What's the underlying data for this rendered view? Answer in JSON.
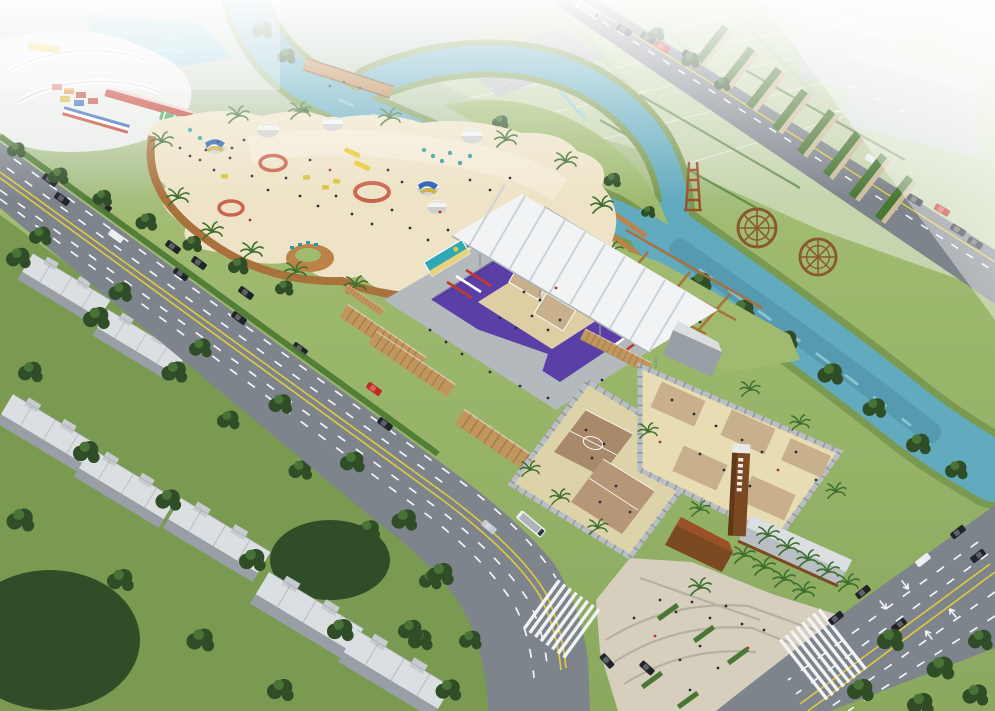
{
  "meta": {
    "title": "Aerial rendering of beach volleyball venue",
    "width": 995,
    "height": 711
  },
  "scene": {
    "description": "Bird's-eye architectural rendering: beach volleyball stadium with purple stands and white canopy, sand beach park with volleyball-pattern dome tents, fenced outdoor sand courts, a teal canal with wooden bridge and waterwheel sculptures, farmland in the haze, multi-lane roads with traffic, and gray residential slabs among trees.",
    "elements": [
      {
        "name": "stadium",
        "details": "U-shaped grandstand, purple seats, white ribbed canopy, central sand court with two tan match courts"
      },
      {
        "name": "beach-park",
        "details": "large free-form sand beach, dome tents (white and volleyball blue/yellow), red sand-art rings, yellow slides and buggies, teal loungers, palms, crowds"
      },
      {
        "name": "outdoor-courts",
        "details": "two walled enclosures: one with two brown courts, one with sand and five tan practice courts"
      },
      {
        "name": "sign-tower",
        "details": "tall wooden pylon with vertical sign marks (text not legible)"
      },
      {
        "name": "river",
        "details": "teal canal forking around a green island; wooden bridge, bank piers, two lattice waterwheel sculptures, wooden tower sculpture"
      },
      {
        "name": "main-road",
        "details": "diagonal arterial with double yellow centerline, dashed lanes, cars, white bus, zebra crossing"
      },
      {
        "name": "cross-road",
        "details": "second road lower right with lane arrows, zebra crossing, cars"
      },
      {
        "name": "top-road",
        "details": "road along the farmland with bus and cars"
      },
      {
        "name": "farmland",
        "details": "pale green crop plots with hedge rows fading into mist"
      },
      {
        "name": "northwest-venue",
        "details": "white curved leisure complex with pond, red-roof building, green striped pavilions, colorful stands"
      },
      {
        "name": "residential",
        "details": "seven gray apartment slabs among dense dark trees"
      },
      {
        "name": "plaza",
        "details": "paved entry plaza with planters, palm rows and pedestrians"
      },
      {
        "name": "hazy-buildings",
        "details": "fog-covered gray boxes upper right with flying birds"
      }
    ],
    "approx_counts": {
      "dome_tents": 6,
      "waterwheels": 2,
      "enclosed_courts": 7,
      "apartment_blocks": 7,
      "vehicles": 34,
      "sand_art_rings": 3
    }
  },
  "colors": {
    "mist": "#ffffff",
    "sky_top": "#c6d1d3",
    "grass": "#8aa95e",
    "grass_light": "#a0bb70",
    "grass_dark": "#7a9a52",
    "farmland": "#c6d5ae",
    "farmland_alt": "#b7cb9d",
    "tree_dark": "#2f4d27",
    "tree_mid": "#497336",
    "tree_light": "#68944a",
    "palm": "#3f7030",
    "hedge": "#4a7833",
    "river": "#62abbe",
    "river_light": "#93ccd6",
    "river_deep": "#47899e",
    "lake": "#7fc0cf",
    "road": "#7e848c",
    "road_dark": "#6d737b",
    "lane_white": "#f2f4f5",
    "lane_yellow": "#e2c93e",
    "sidewalk": "#b8bcc0",
    "plaza_paving": "#d6cfbd",
    "plaza_band": "#b3ada0",
    "plaza_gray": "#b4b9bd",
    "sand_beach": "#eee3c6",
    "sand_bright": "#f5edd9",
    "sand_stadium": "#dfcda4",
    "sand_outdoor": "#e8ddb2",
    "court_tan": "#c8b08d",
    "court_brown": "#a8896a",
    "court_brown2": "#b59778",
    "boardwalk": "#a9713c",
    "wood_deck": "#bc8348",
    "wood_dark": "#7c4a22",
    "container": "#c0965c",
    "container_dark": "#9f7a42",
    "seat_purple": "#5a3fa6",
    "seat_purple_dark": "#46318a",
    "canopy": "#f1f3f4",
    "canopy_rib": "#ccd3d6",
    "wall_gray": "#b9bec2",
    "wall_dark": "#8f959a",
    "building_face": "#c7cbcf",
    "building_side": "#989fa6",
    "building_top": "#dcdfe2",
    "haze_building": "#ccd3d6",
    "wood_structure": "#8b5930",
    "rust": "#9c5027",
    "red_accent": "#c03a2b",
    "sand_art": "#c0452e",
    "billboard_teal": "#2fa9b8",
    "billboard_sand": "#e6d37a",
    "kiosk_green": "#47a156",
    "bus_white": "#eef0f1",
    "car_black": "#20242a",
    "car_red": "#c22a1f",
    "car_silver": "#c7cbd0",
    "car_white": "#e9ebec",
    "people": "#2c3038",
    "people_accent": "#b5352c",
    "slide_yellow": "#e8c832",
    "umbrella_teal": "#2e9aa0",
    "buggy_yellow": "#d8c43a",
    "stripe_blue": "#2b5fb0"
  }
}
